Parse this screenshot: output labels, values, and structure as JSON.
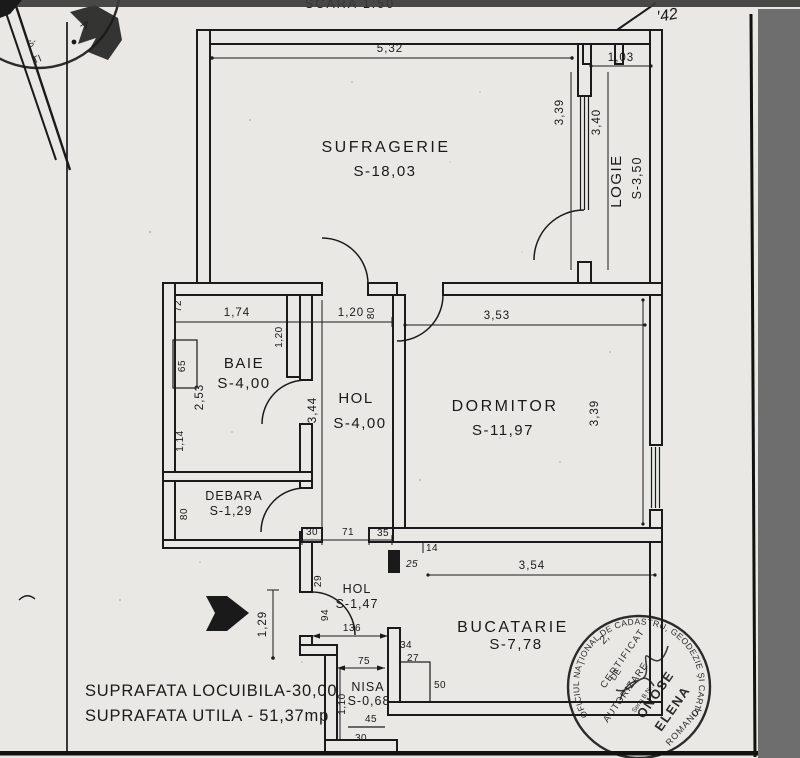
{
  "colors": {
    "paper": "#e9e8e4",
    "ink": "#1a1a1a",
    "band": "#3a3a3a",
    "scan": "#6e6e6e"
  },
  "page": {
    "scale_label": "SCARA 1:50",
    "handwritten_note": "′42",
    "summary_line1": "SUPRAFATA LOCUIBILA-30,00",
    "summary_line2": "SUPRAFATA UTILA - 51,37mp"
  },
  "rooms": {
    "sufragerie": {
      "name": "SUFRAGERIE",
      "area": "S-18,03"
    },
    "logie": {
      "name": "LOGIE",
      "area": "S-3,50"
    },
    "baie": {
      "name": "BAIE",
      "area": "S-4,00"
    },
    "hol1": {
      "name": "HOL",
      "area": "S-4,00"
    },
    "dormitor": {
      "name": "DORMITOR",
      "area": "S-11,97"
    },
    "debara": {
      "name": "DEBARA",
      "area": "S-1,29"
    },
    "hol2": {
      "name": "HOL",
      "area": "S-1,47"
    },
    "bucatarie": {
      "name": "BUCATARIE",
      "area": "S-7,78"
    },
    "nisa": {
      "name": "NISA",
      "area": "S-0,68"
    }
  },
  "dims": {
    "top_width": "5,32",
    "logie_width": "1,03",
    "suf_right_height": "3,39",
    "logie_height": "3,40",
    "baie_corner": "72",
    "baie_width": "1,74",
    "hol_top_width": "1,20",
    "hol_top_wall": "80",
    "baie_door_height": "1,20",
    "baie_fixture": "65",
    "baie_left_height": "2,53",
    "baie_left_lower": "1,14",
    "hol_height": "3,44",
    "dorm_width": "3,53",
    "dorm_right_height": "3,39",
    "debara_left": "80",
    "seg_30": "30",
    "seg_71": "71",
    "seg_35": "35",
    "seg_14": "14",
    "seg_25": "25",
    "buc_width": "3,54",
    "hol2_corner": "29",
    "hol2_door": "94",
    "entry_recess": "1,29",
    "hol2_width": "136",
    "seg_34": "34",
    "seg_27": "27",
    "nisa_width": "75",
    "nisa_height": "1,10",
    "nisa_inner": "45",
    "nisa_bottom": "30",
    "fixture_width": "50"
  },
  "stamps": {
    "corner": {
      "f1": "A",
      "f2": "TI",
      "f3": "S-"
    },
    "main": {
      "ring": "OFICIUL NAŢIONAL DE CADASTRU, GEODEZIE ŞI CARTOGRAFIE",
      "country": "ROMANIA",
      "line1": "CERTIFICAT",
      "line2": "DE",
      "line3": "AUTORIZARE",
      "series": "Seria B Nr.",
      "name1": "ONOSE",
      "name2": "ELENA",
      "note": "2,"
    }
  }
}
